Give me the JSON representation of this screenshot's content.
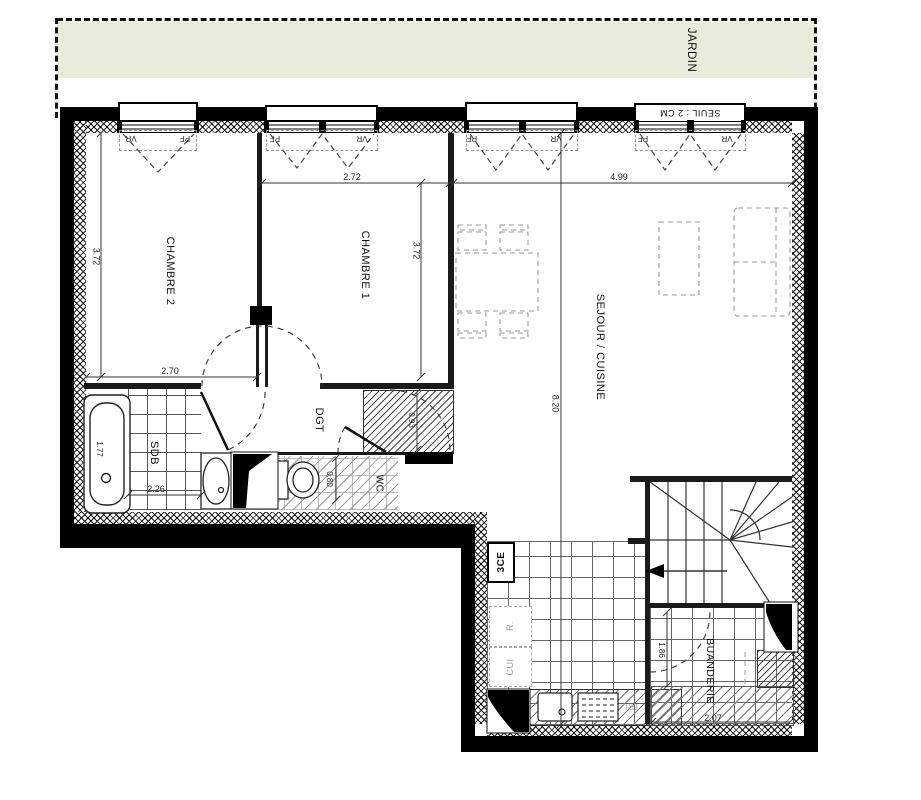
{
  "plan": {
    "title": "apartment-floor-plan",
    "garden_label": "JARDIN",
    "rooms": {
      "chambre2": {
        "label": "CHAMBRE 2",
        "width": "2.70",
        "height": "3.72"
      },
      "chambre1": {
        "label": "CHAMBRE 1",
        "width": "2.72",
        "height": "3.72"
      },
      "sejour": {
        "label": "SEJOUR / CUISINE",
        "width": "4.99",
        "height": "8.20"
      },
      "sdb": {
        "label": "SDB",
        "width": "2.26",
        "bath_length": "1.77"
      },
      "dgt": {
        "label": "DGT"
      },
      "wc": {
        "label": "WC",
        "depth": "0.80"
      },
      "shaft": {
        "label": "3CE",
        "width": "0.93"
      },
      "buanderie": {
        "label": "BUANDERIE",
        "height": "1.86",
        "width": "2.07"
      },
      "kitchen": {
        "fridge": "R.",
        "unit": "CUI",
        "tri": "TRI"
      }
    },
    "windows": {
      "seuil_note": "SEUIL : 2 CM",
      "w1": {
        "left": "VR",
        "right": "PF"
      },
      "w2": {
        "left": "PF",
        "right": "VR"
      },
      "w3": {
        "left": "PF",
        "right": "VR"
      },
      "w4": {
        "left": "PF",
        "right": "VR"
      }
    },
    "colors": {
      "garden": "#e7ebd9",
      "walls": "#000000",
      "hatch": "#444444",
      "furniture_dash": "#9a9a9a"
    }
  }
}
